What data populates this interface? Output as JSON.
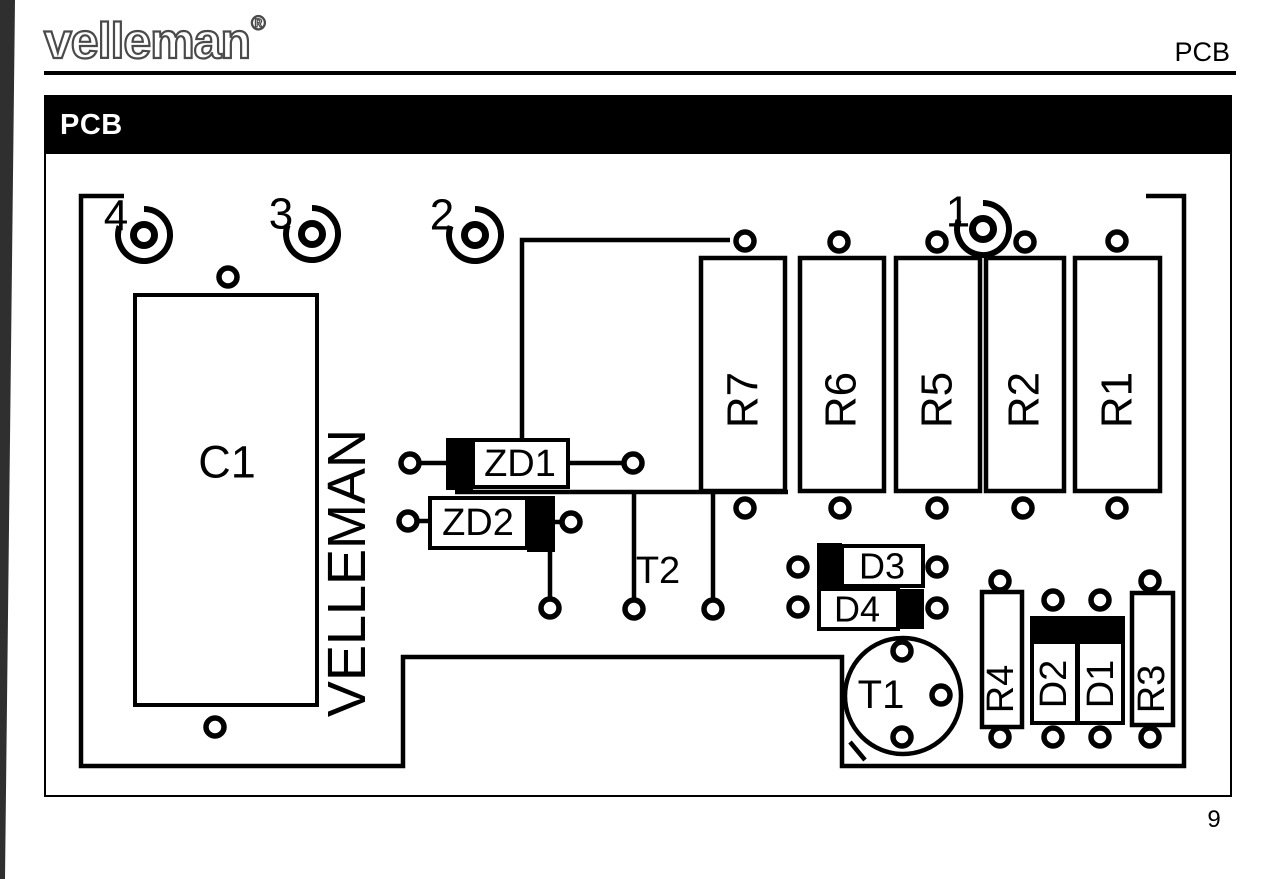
{
  "header": {
    "logo_text": "velleman",
    "registered_mark": "®",
    "corner_label": "PCB",
    "section_title": "PCB"
  },
  "footer": {
    "page_number": "9"
  },
  "pcb": {
    "silkscreen_brand": "VELLEMAN",
    "solder_points": {
      "p1": "1",
      "p2": "2",
      "p3": "3",
      "p4": "4"
    },
    "components": {
      "c1": "C1",
      "r1": "R1",
      "r2": "R2",
      "r3": "R3",
      "r4": "R4",
      "r5": "R5",
      "r6": "R6",
      "r7": "R7",
      "d1": "D1",
      "d2": "D2",
      "d3": "D3",
      "d4": "D4",
      "zd1": "ZD1",
      "zd2": "ZD2",
      "t1": "T1",
      "t2": "T2"
    }
  }
}
